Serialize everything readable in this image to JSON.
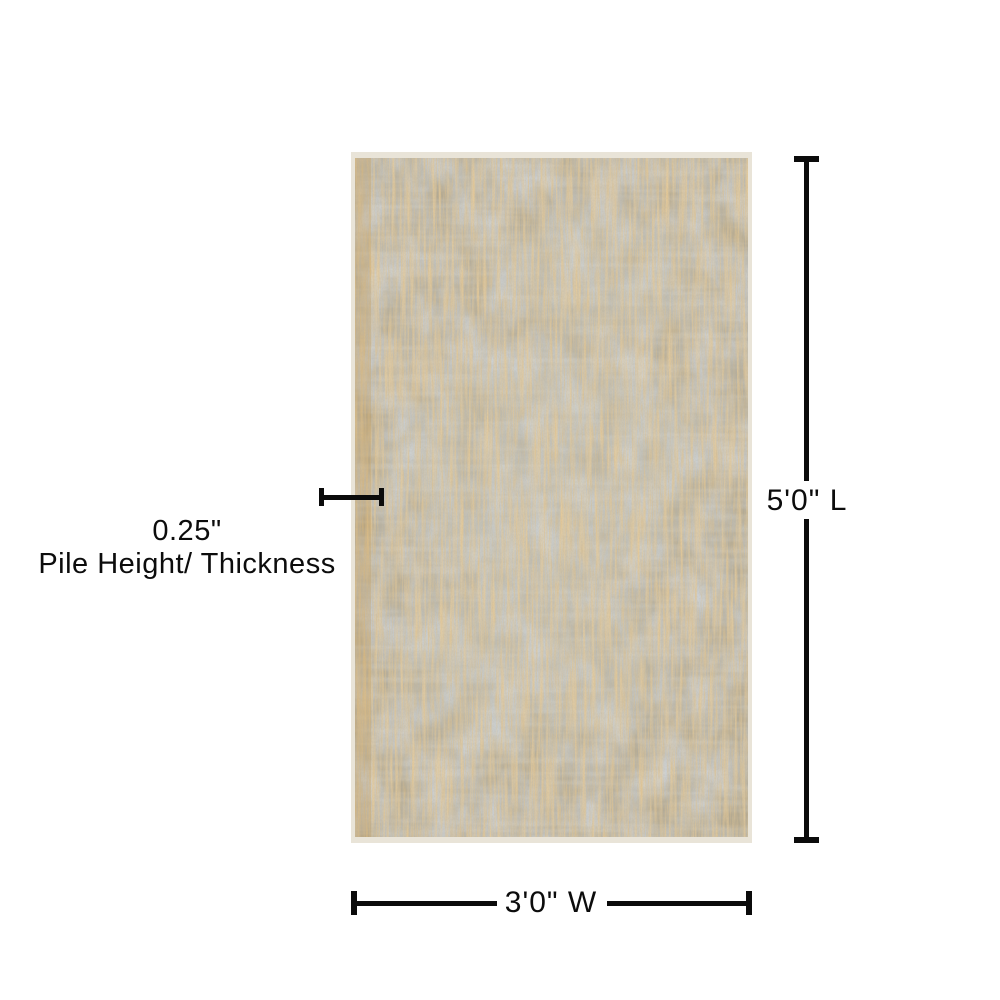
{
  "page": {
    "background": "#ffffff"
  },
  "product": {
    "name": "Distressed vintage gold and gray area rug, top view"
  },
  "annotations": {
    "length": {
      "label": "5'0\" L"
    },
    "width": {
      "label": "3'0\" W"
    },
    "pile": {
      "value": "0.25\"",
      "caption": "Pile Height/ Thickness"
    }
  },
  "colors": {
    "background": "#ffffff",
    "line": "#0b0b0b",
    "text": "#0c0c0c",
    "rug_gold": "#c89a55",
    "rug_gray_blue": "#98a2a8",
    "rug_light_gray": "#c6cbc9",
    "rug_edge_cream": "#e9e4d8"
  }
}
